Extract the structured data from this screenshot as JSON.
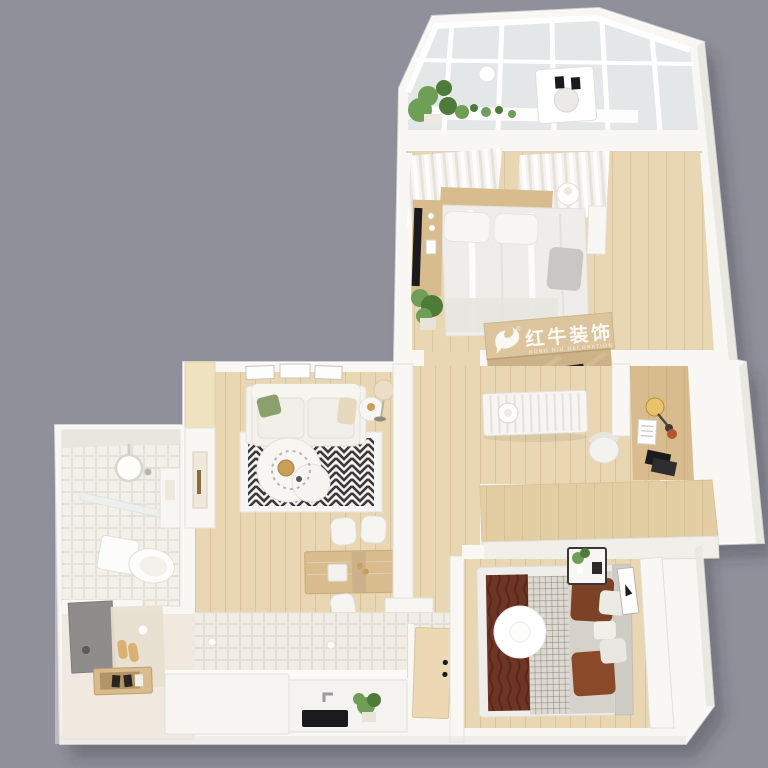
{
  "watermark": {
    "logo_icon": "bull-logo-icon",
    "registered": "®",
    "brand": "红牛装饰",
    "subtitle": "HONG NIU DECORATION"
  },
  "palette": {
    "background": "#90909A",
    "shadow": "#30303A",
    "wall_white": "#F8F7F3",
    "wall_shade": "#E9E6E0",
    "wall_edge": "#D8D4CC",
    "glass": "#E3E7E7",
    "floor_wood": "#E9D6B2",
    "floor_wood_deep": "#E3CDA2",
    "tile_cream": "#F1EDE4",
    "tile_bath": "#F3F0EA",
    "rug_base": "#F6F5F2",
    "rug_black": "#2B2B2E",
    "sofa_white": "#F3F1EB",
    "furniture_wood": "#D9BC8E",
    "furniture_wood_light": "#EFE3BF",
    "bed_white": "#EFEDE9",
    "bed_gray": "#C9C7C3",
    "maroon": "#6E3524",
    "pillow_brown": "#7C4226",
    "plant_green": "#6F9E56",
    "plant_green_dark": "#4E7A3A",
    "watermark_tan": "#DCC49C",
    "watermark_tan_dark": "#CDB187",
    "black": "#1B1B1E",
    "lamp_warm": "#E9C36A",
    "accent_red": "#B4552E",
    "mat_gray": "#8E8D8B"
  }
}
